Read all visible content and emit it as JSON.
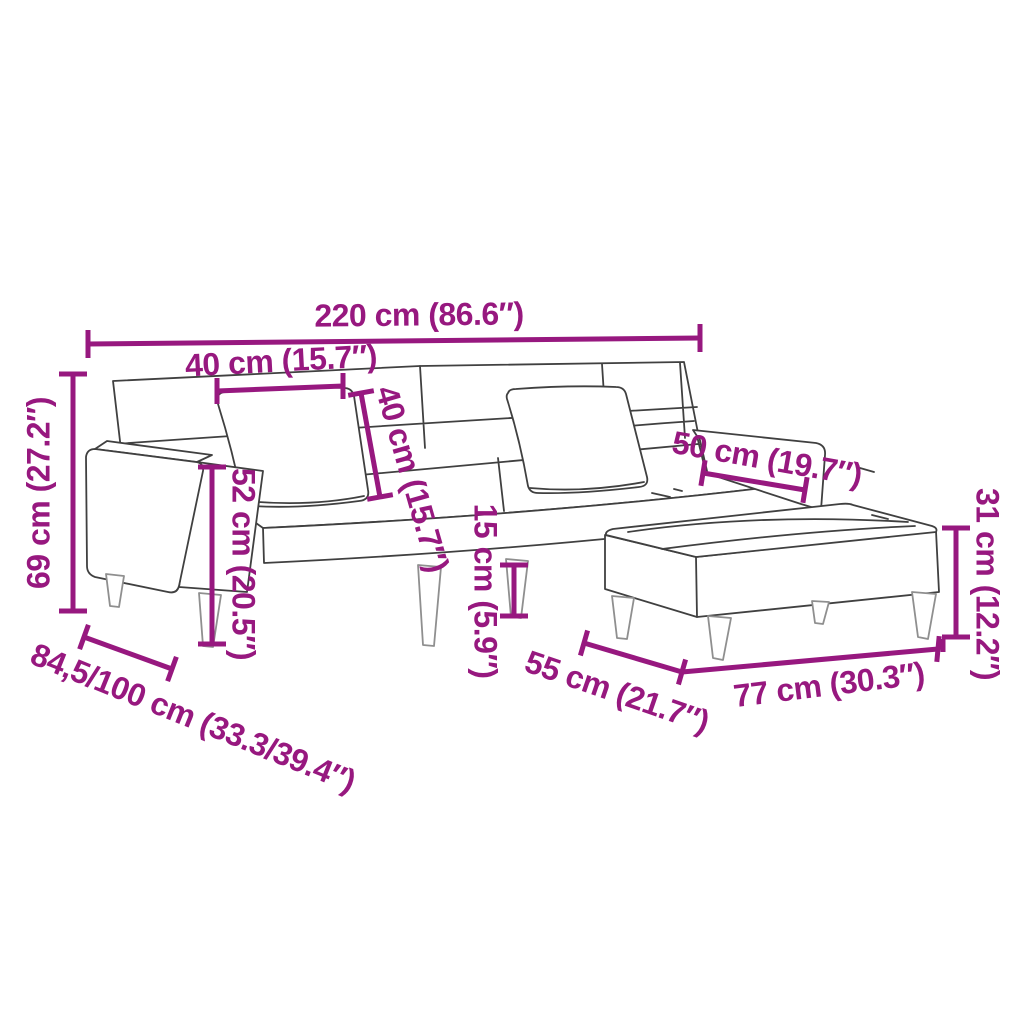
{
  "colors": {
    "dimension_accent": "#97187F",
    "furniture_outline": "#404040",
    "leg_outline": "#8f8f8f",
    "background": "#ffffff"
  },
  "dimensions": {
    "sofa_width": {
      "label": "220 cm (86.6″)"
    },
    "pillow_width": {
      "label": "40 cm (15.7″)"
    },
    "pillow_height": {
      "label": "40 cm (15.7″)"
    },
    "armrest_depth": {
      "label": "50 cm (19.7″)"
    },
    "sofa_height": {
      "label": "69 cm (27.2″)"
    },
    "seat_back_height": {
      "label": "52 cm (20.5″)"
    },
    "leg_height": {
      "label": "15 cm (5.9″)"
    },
    "stool_height": {
      "label": "31 cm (12.2″)"
    },
    "sofa_depth": {
      "label": "84,5/100 cm (33.3/39.4″)"
    },
    "stool_depth": {
      "label": "55 cm (21.7″)"
    },
    "stool_width": {
      "label": "77 cm (30.3″)"
    }
  }
}
